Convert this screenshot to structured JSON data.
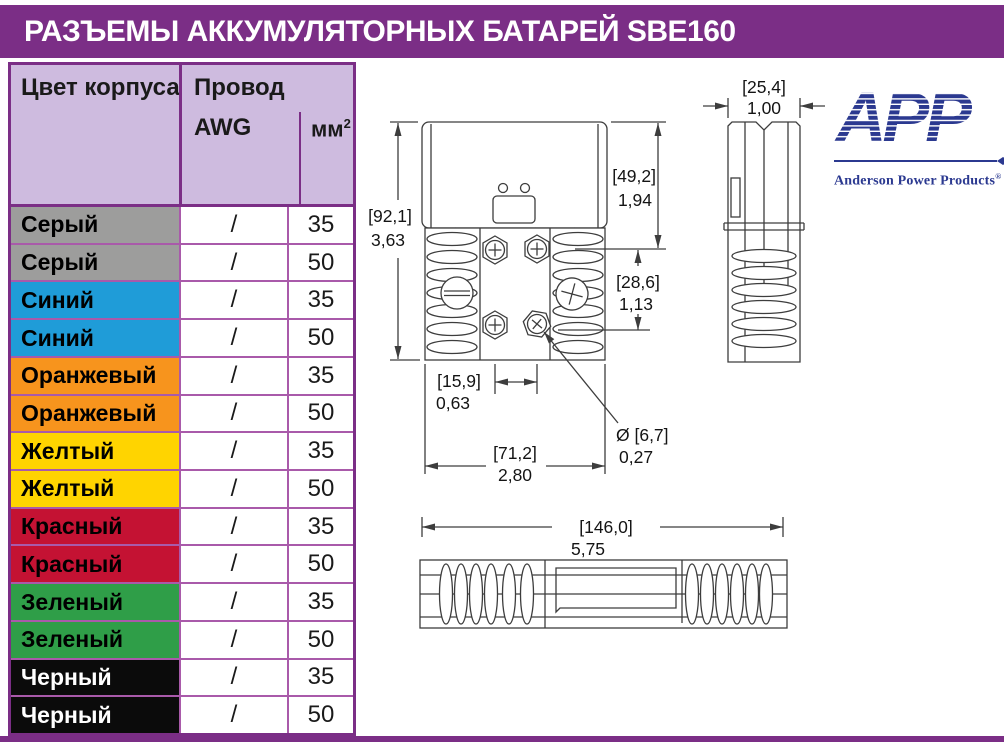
{
  "page": {
    "title": "РАЗЪЕМЫ АККУМУЛЯТОРНЫХ БАТАРЕЙ SBE160"
  },
  "theme": {
    "accent_purple": "#7b2e86",
    "grid_violet": "#a95aaa",
    "header_lavender": "#cebbdf",
    "logo_navy": "#2b3990"
  },
  "logo": {
    "acronym": "APP",
    "name": "Anderson Power Products",
    "reg": "®"
  },
  "table": {
    "col1_header": "Цвет корпуса",
    "group_header": "Провод",
    "sub_awg": "AWG",
    "sub_mm_base": "мм",
    "sub_mm_sup": "2",
    "rows": [
      {
        "color_name": "Серый",
        "swatch": "#9d9d9c",
        "fg": "#000000",
        "awg": "/",
        "mm2": "35"
      },
      {
        "color_name": "Серый",
        "swatch": "#9d9d9c",
        "fg": "#000000",
        "awg": "/",
        "mm2": "50"
      },
      {
        "color_name": "Синий",
        "swatch": "#1f9cd8",
        "fg": "#000000",
        "awg": "/",
        "mm2": "35"
      },
      {
        "color_name": "Синий",
        "swatch": "#1f9cd8",
        "fg": "#000000",
        "awg": "/",
        "mm2": "50"
      },
      {
        "color_name": "Оранжевый",
        "swatch": "#f7941d",
        "fg": "#000000",
        "awg": "/",
        "mm2": "35"
      },
      {
        "color_name": "Оранжевый",
        "swatch": "#f7941d",
        "fg": "#000000",
        "awg": "/",
        "mm2": "50"
      },
      {
        "color_name": "Желтый",
        "swatch": "#ffd400",
        "fg": "#000000",
        "awg": "/",
        "mm2": "35"
      },
      {
        "color_name": "Желтый",
        "swatch": "#ffd400",
        "fg": "#000000",
        "awg": "/",
        "mm2": "50"
      },
      {
        "color_name": "Красный",
        "swatch": "#c41233",
        "fg": "#000000",
        "awg": "/",
        "mm2": "35"
      },
      {
        "color_name": "Красный",
        "swatch": "#c41233",
        "fg": "#000000",
        "awg": "/",
        "mm2": "50"
      },
      {
        "color_name": "Зеленый",
        "swatch": "#2f9e48",
        "fg": "#000000",
        "awg": "/",
        "mm2": "35"
      },
      {
        "color_name": "Зеленый",
        "swatch": "#2f9e48",
        "fg": "#000000",
        "awg": "/",
        "mm2": "50"
      },
      {
        "color_name": "Черный",
        "swatch": "#0b0b0b",
        "fg": "#ffffff",
        "awg": "/",
        "mm2": "35"
      },
      {
        "color_name": "Черный",
        "swatch": "#0b0b0b",
        "fg": "#ffffff",
        "awg": "/",
        "mm2": "50"
      }
    ]
  },
  "drawing": {
    "front": {
      "height_mm": "[92,1]",
      "height_in": "3,63",
      "upper_mm": "[49,2]",
      "upper_in": "1,94",
      "mid_mm": "[28,6]",
      "mid_in": "1,13",
      "pitch_mm": "[15,9]",
      "pitch_in": "0,63",
      "width_mm": "[71,2]",
      "width_in": "2,80",
      "hole_mm": "Ø [6,7]",
      "hole_in": "0,27"
    },
    "side": {
      "width_mm": "[25,4]",
      "width_in": "1,00"
    },
    "bottom": {
      "length_mm": "[146,0]",
      "length_in": "5,75"
    }
  }
}
